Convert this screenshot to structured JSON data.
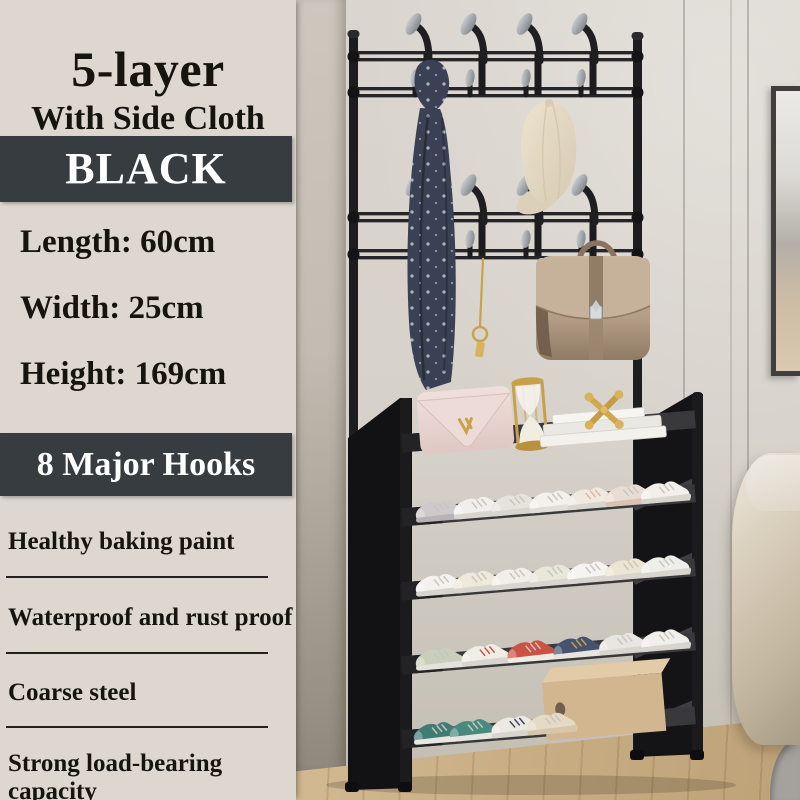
{
  "info_panel": {
    "title": "5-layer",
    "subtitle": "With Side Cloth",
    "color_badge": "BLACK",
    "dimensions": [
      "Length: 60cm",
      "Width: 25cm",
      "Height: 169cm"
    ],
    "hooks_badge": "8 Major Hooks",
    "features": [
      "Healthy baking paint",
      "Waterproof and rust proof",
      "Coarse steel",
      "Strong load-bearing capacity"
    ]
  },
  "photo": {
    "scene_items": [
      "coat-rack-with-8-hooks",
      "scarf",
      "baseball-cap",
      "hanging-handbag",
      "gold-keychain",
      "pink-clutch",
      "gold-hourglass",
      "book-stack",
      "gold-ornament",
      "sneakers",
      "shoe-box",
      "armchair",
      "wall-art-frame",
      "rug"
    ]
  },
  "colors": {
    "panel_background": "#ddd7cf",
    "badge_background": "#373c41",
    "badge_text": "#ffffff",
    "body_text": "#16140f",
    "rack_metal": "#1d1d20",
    "wall": "#d6d1c9",
    "floor_wood": "#c7ac83",
    "scarf_navy": "#3a4154",
    "handbag_tan": "#bca78f",
    "clutch_pink": "#ecdad5",
    "gold_accent": "#c9a24b"
  }
}
